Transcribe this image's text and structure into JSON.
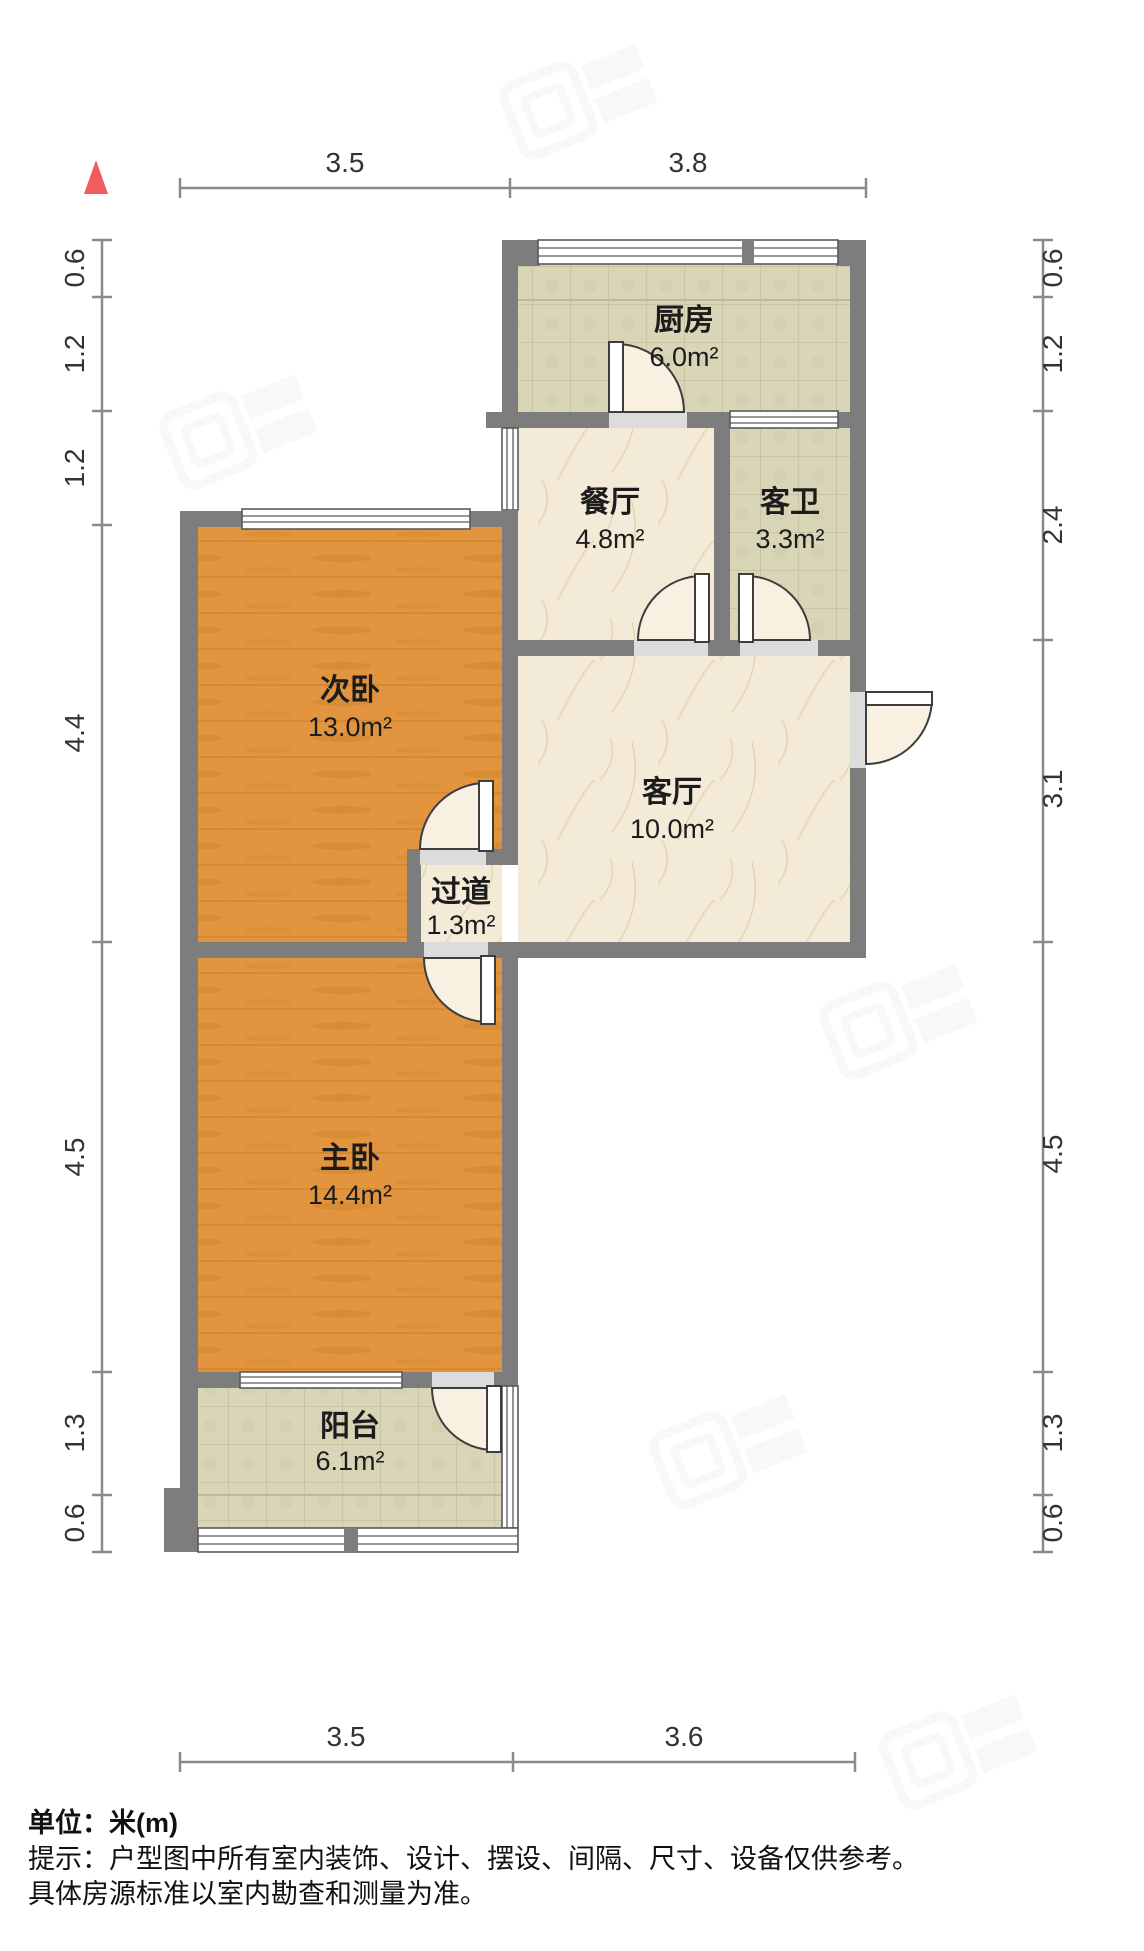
{
  "colors": {
    "wall": "#7d7d7d",
    "wood_floor": "#e2953e",
    "tile_floor": "#d9d5b7",
    "marble_floor": "#f3ead7",
    "north_arrow": "#f25c5c",
    "dim_text": "#333333"
  },
  "north_arrow": {
    "icon": "red-triangle-north"
  },
  "rooms": {
    "kitchen": {
      "label": "厨房",
      "area": "6.0m²",
      "floor": "tile"
    },
    "dining": {
      "label": "餐厅",
      "area": "4.8m²",
      "floor": "marble"
    },
    "guest_bath": {
      "label": "客卫",
      "area": "3.3m²",
      "floor": "tile"
    },
    "second_bedroom": {
      "label": "次卧",
      "area": "13.0m²",
      "floor": "wood"
    },
    "living": {
      "label": "客厅",
      "area": "10.0m²",
      "floor": "marble"
    },
    "hallway": {
      "label": "过道",
      "area": "1.3m²",
      "floor": "marble"
    },
    "master_bedroom": {
      "label": "主卧",
      "area": "14.4m²",
      "floor": "wood"
    },
    "balcony": {
      "label": "阳台",
      "area": "6.1m²",
      "floor": "tile"
    }
  },
  "dimensions": {
    "top": [
      "3.5",
      "3.8"
    ],
    "bottom": [
      "3.5",
      "3.6"
    ],
    "left": [
      "0.6",
      "1.2",
      "1.2",
      "4.4",
      "4.5",
      "1.3",
      "0.6"
    ],
    "right": [
      "0.6",
      "1.2",
      "2.4",
      "3.1",
      "4.5",
      "1.3",
      "0.6"
    ]
  },
  "notes": {
    "unit": "单位：米(m)",
    "tip1": "提示：户型图中所有室内装饰、设计、摆设、间隔、尺寸、设备仅供参考。",
    "tip2": "具体房源标准以室内勘查和测量为准。"
  }
}
